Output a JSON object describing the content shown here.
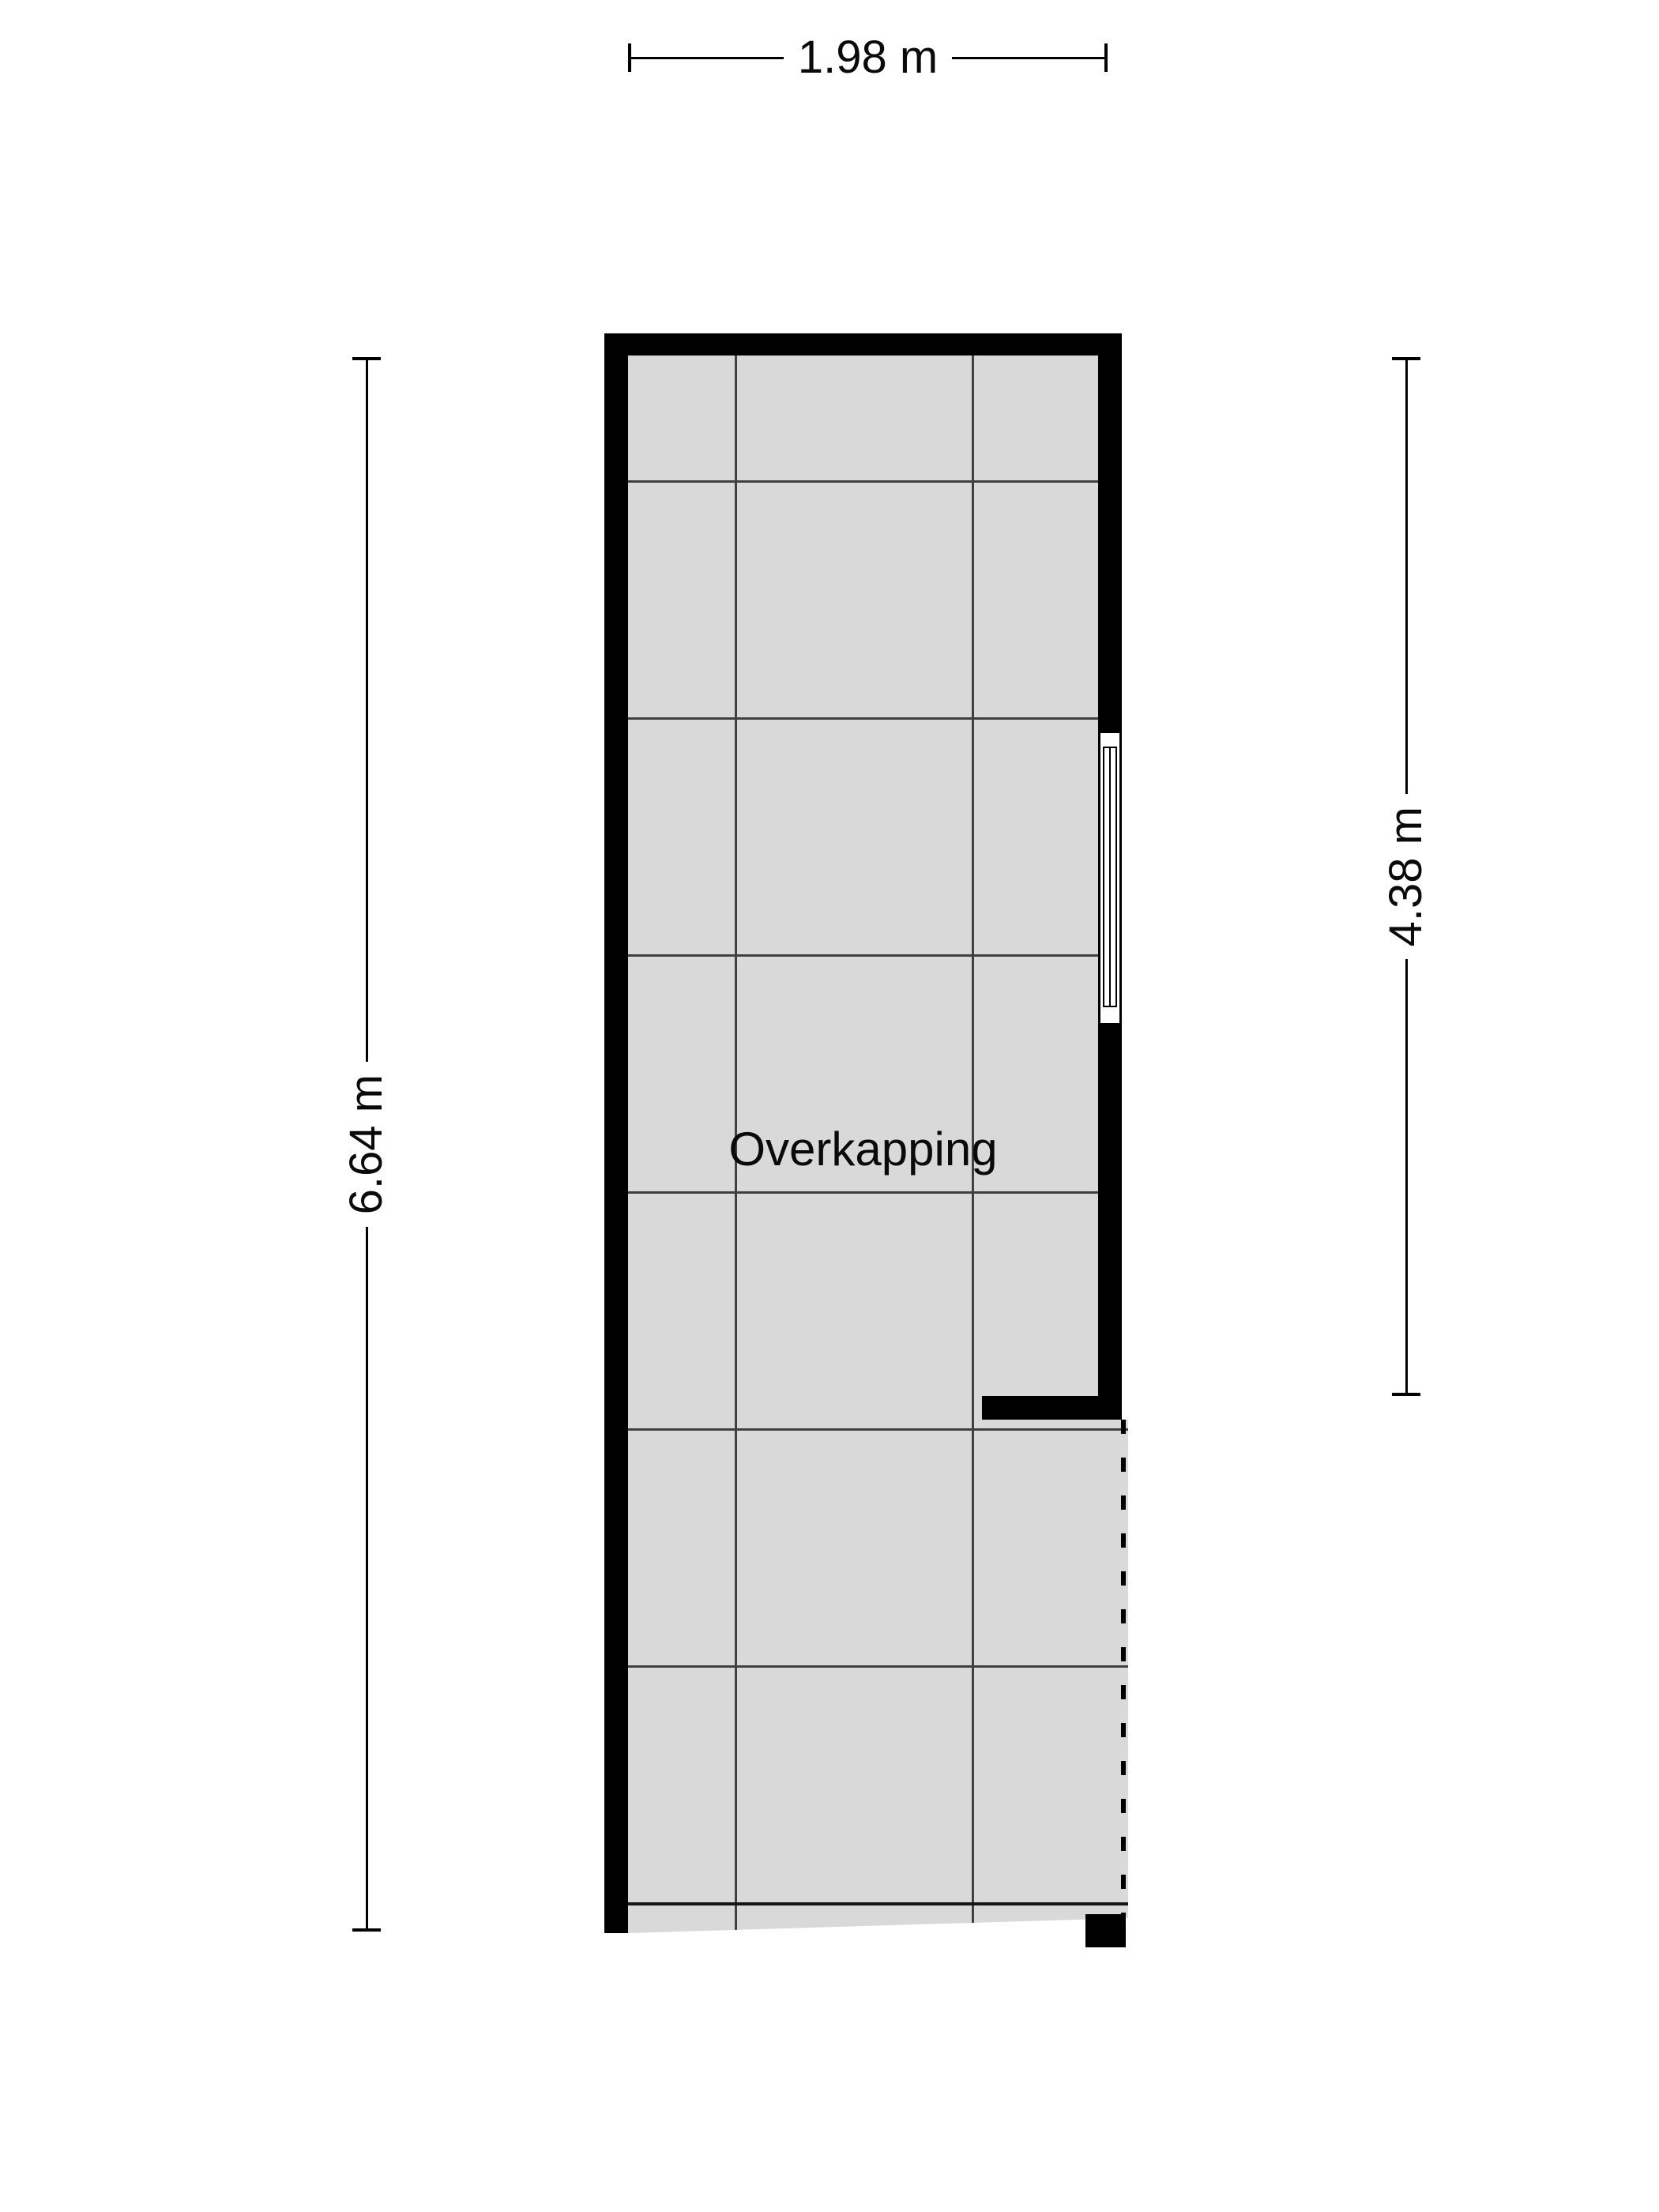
{
  "floorplan": {
    "room_label": "Overkapping",
    "dimensions": {
      "width_top": "1.98 m",
      "height_left": "6.64 m",
      "height_right": "4.38 m"
    },
    "colors": {
      "background": "#ffffff",
      "wall": "#000000",
      "floor": "#d9d9d9",
      "grid_line": "#404040",
      "grid_line_strong": "#161616",
      "text": "#0a0a0a"
    }
  }
}
